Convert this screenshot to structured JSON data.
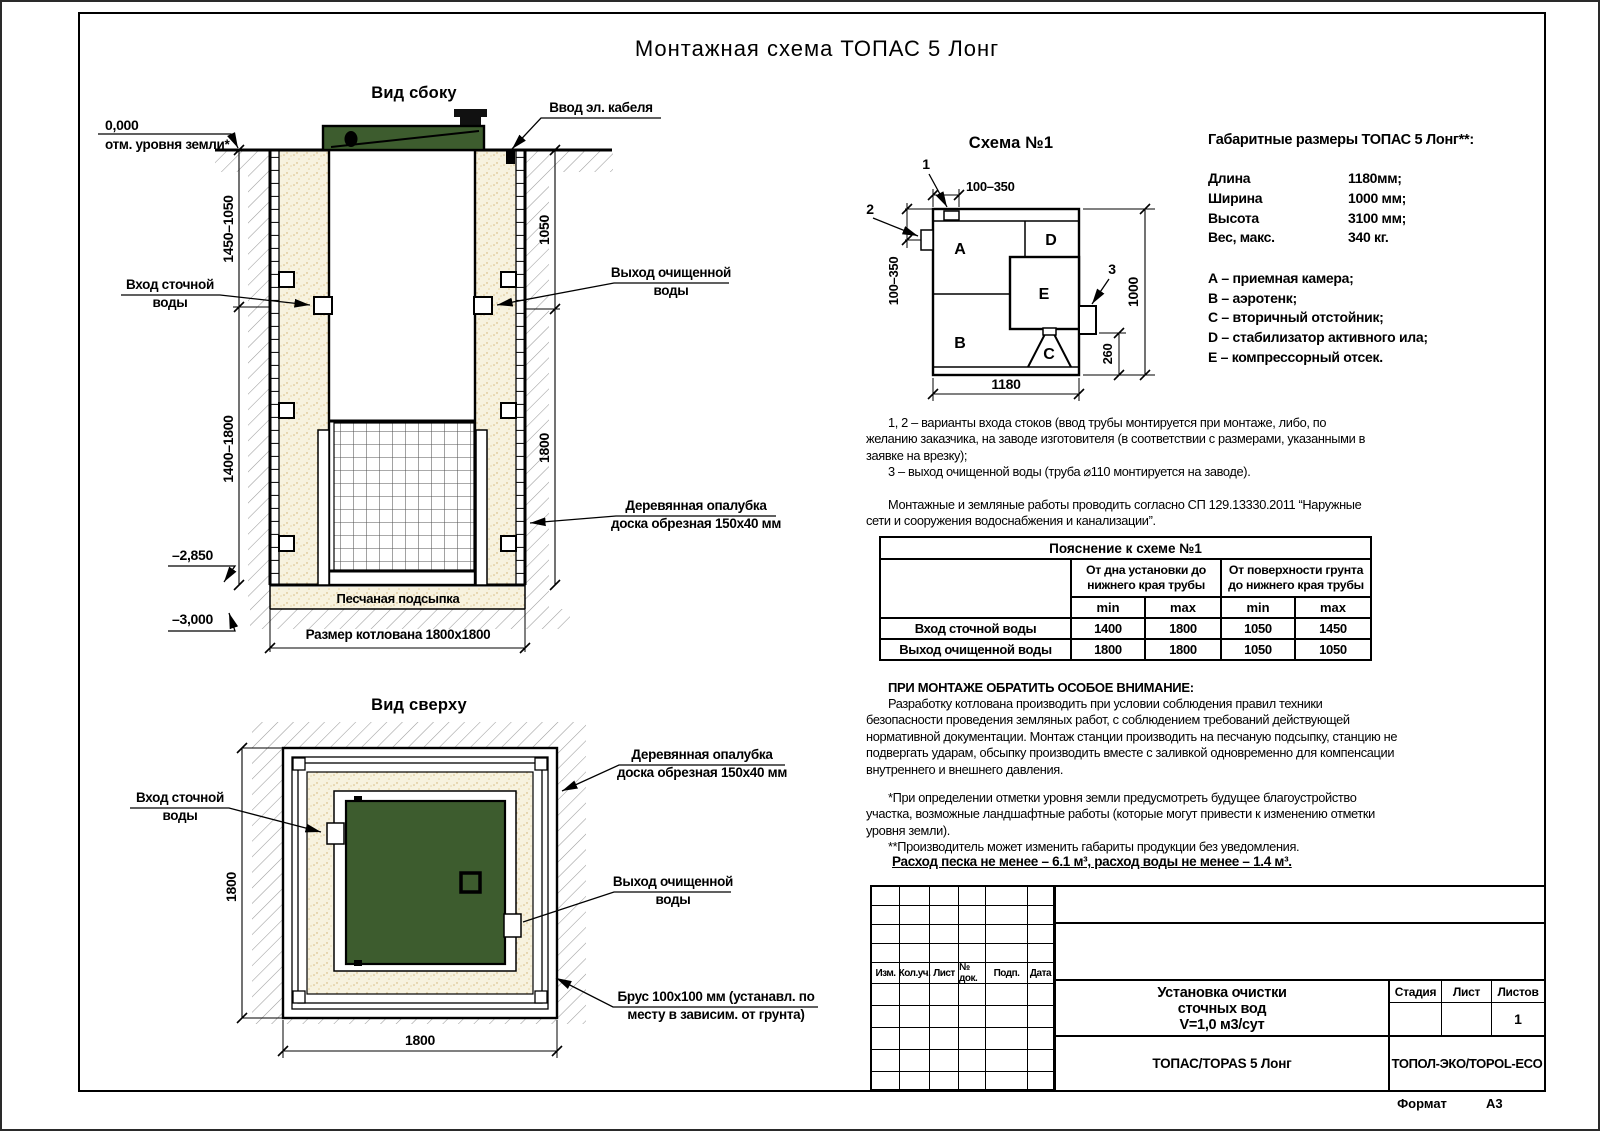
{
  "page": {
    "title": "Монтажная схема ТОПАС 5 Лонг",
    "format_label": "Формат",
    "format_value": "А3"
  },
  "side_view": {
    "title": "Вид сбоку",
    "zero_mark": "0,000",
    "ground_label": "отм. уровня земли*",
    "cable_label": "Ввод эл. кабеля",
    "inlet_l1": "Вход сточной",
    "inlet_l2": "воды",
    "outlet_l1": "Выход очищенной",
    "outlet_l2": "воды",
    "formwork_l1": "Деревянная опалубка",
    "formwork_l2": "доска обрезная 150х40 мм",
    "sand_label": "Песчаная подсыпка",
    "pit_label": "Размер котлована 1800х1800",
    "dim_left_top": "1450–1050",
    "dim_left_bottom": "1400–1800",
    "dim_right_top": "1050",
    "dim_right_bottom": "1800",
    "mark_top": "–2,850",
    "mark_bottom": "–3,000"
  },
  "top_view": {
    "title": "Вид сверху",
    "inlet_l1": "Вход сточной",
    "inlet_l2": "воды",
    "outlet_l1": "Выход очищенной",
    "outlet_l2": "воды",
    "formwork_l1": "Деревянная опалубка",
    "formwork_l2": "доска обрезная 150х40 мм",
    "beam_l1": "Брус 100х100 мм (устанавл. по",
    "beam_l2": "месту в зависим. от грунта)",
    "dim_left": "1800",
    "dim_bottom": "1800"
  },
  "scheme": {
    "title": "Схема №1",
    "comp_a": "A",
    "comp_b": "B",
    "comp_c": "C",
    "comp_d": "D",
    "comp_e": "E",
    "callout_1": "1",
    "callout_2": "2",
    "callout_3": "3",
    "dim_top": "100–350",
    "dim_left": "100–350",
    "dim_right": "1000",
    "dim_offset": "260",
    "dim_bottom": "1180"
  },
  "specs": {
    "heading": "Габаритные размеры ТОПАС 5 Лонг**:",
    "rows": [
      {
        "label": "Длина",
        "value": "1180мм;"
      },
      {
        "label": "Ширина",
        "value": "1000 мм;"
      },
      {
        "label": "Высота",
        "value": "3100 мм;"
      },
      {
        "label": "Вес, макс.",
        "value": "340 кг."
      }
    ],
    "legend": [
      "А – приемная камера;",
      "В – аэротенк;",
      "С – вторичный отстойник;",
      "D – стабилизатор активного ила;",
      "Е – компрессорный отсек."
    ]
  },
  "notes": {
    "note1": "1, 2 – варианты входа  стоков (ввод трубы монтируется при монтаже, либо, по желанию заказчика, на заводе изготовителя (в соответствии с размерами, указанными в заявке на врезку);",
    "note2": "3 – выход очищенной воды (труба ⌀110 монтируется на заводе).",
    "note3": "Монтажные и земляные работы проводить согласно СП 129.13330.2011 “Наружные сети и сооружения водоснабжения и канализации”."
  },
  "table": {
    "title": "Пояснение к схеме №1",
    "group1": "От дна установки до нижнего края трубы",
    "group2": "От поверхности грунта до нижнего края трубы",
    "min_label": "min",
    "max_label": "max",
    "rows": [
      {
        "label": "Вход сточной воды",
        "c1": "1400",
        "c2": "1800",
        "c3": "1050",
        "c4": "1450"
      },
      {
        "label": "Выход очищенной воды",
        "c1": "1800",
        "c2": "1800",
        "c3": "1050",
        "c4": "1050"
      }
    ]
  },
  "attention": {
    "heading": "ПРИ МОНТАЖЕ ОБРАТИТЬ ОСОБОЕ ВНИМАНИЕ:",
    "body": "Разработку котлована производить при условии соблюдения правил техники безопасности проведения земляных работ, с соблюдением требований действующей нормативной документации. Монтаж станции производить на песчаную подсыпку, станцию не подвергать ударам, обсыпку производить вместе с заливкой одновременно для компенсации внутреннего и внешнего давления."
  },
  "footnotes": {
    "f1": "*При определении отметки уровня земли предусмотреть будущее благоустройство участка, возможные ландшафтные работы (которые могут привести к изменению отметки уровня земли).",
    "f2": "**Производитель может изменить габариты продукции без уведомления."
  },
  "consumption": "Расход песка не менее – 6.1 м³, расход воды не менее – 1.4 м³.",
  "title_block": {
    "rev_headers": [
      "Изм.",
      "Кол.уч.",
      "Лист",
      "№ док.",
      "Подп.",
      "Дата"
    ],
    "doc_l1": "Установка очистки",
    "doc_l2": "сточных вод",
    "doc_l3": "V=1,0 м3/сут",
    "model": "ТОПАС/TOPAS 5 Лонг",
    "stage_label": "Стадия",
    "sheet_label": "Лист",
    "sheets_label": "Листов",
    "sheets_value": "1",
    "company": "ТОПОЛ-ЭКО/TOPOL-ECO"
  },
  "colors": {
    "green": "#3d5c2e",
    "sand": "#f7f2df",
    "line": "#000000",
    "hatch": "#9b9b9b"
  }
}
